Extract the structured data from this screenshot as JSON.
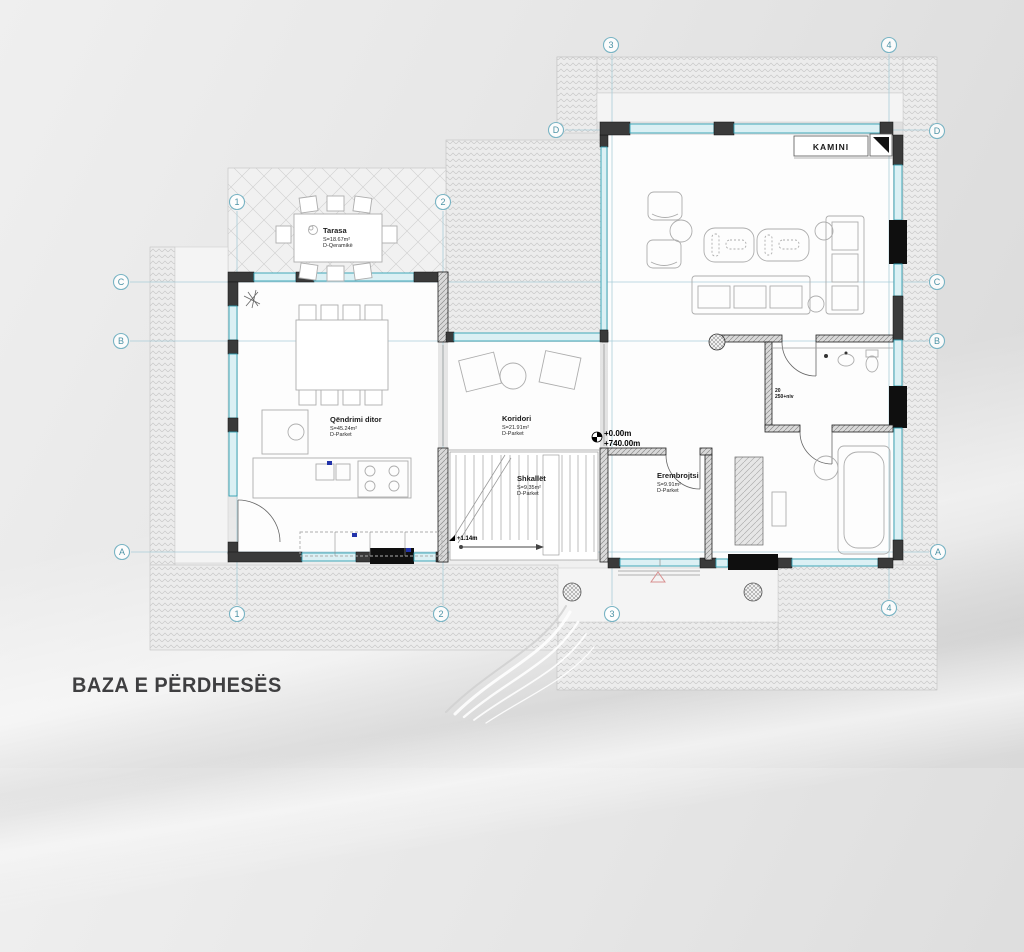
{
  "title": "BAZA E PËRDHESËS",
  "rooms": {
    "tarasa": {
      "name": "Tarasa",
      "area": "S=18.67m²",
      "floor": "D-Qeramikë"
    },
    "qendrimi_ditor": {
      "name": "Qëndrimi ditor",
      "area": "S=45.24m²",
      "floor": "D-Parket"
    },
    "koridori": {
      "name": "Koridori",
      "area": "S=21.91m²",
      "floor": "D-Parket"
    },
    "shkallet": {
      "name": "Shkallët",
      "area": "S=9.35m²",
      "floor": "D-Parket"
    },
    "erembrojtsi": {
      "name": "Erembrojtsi",
      "area": "S=9.91m²",
      "floor": "D-Parket"
    },
    "kamini": {
      "name": "KAMINI"
    }
  },
  "levels": {
    "ground": "+0.00m",
    "absolute": "+740.00m",
    "stair": "+1.14m"
  },
  "annotations": {
    "door_width": "20",
    "door_height": "250+niv"
  },
  "grid": {
    "cols": [
      {
        "label": "1"
      },
      {
        "label": "2"
      },
      {
        "label": "3"
      },
      {
        "label": "4"
      }
    ],
    "rows": [
      {
        "label": "A"
      },
      {
        "label": "B"
      },
      {
        "label": "C"
      },
      {
        "label": "D"
      }
    ]
  },
  "colors": {
    "window": "#2f9fb3",
    "grid_line": "#a9cdd9",
    "bubble": "#79b4c4",
    "wall": "#1e1e1e",
    "site_hatch": "#c9c9c9",
    "triangle_accent": "#d89090",
    "title_text": "#3f3f41"
  }
}
